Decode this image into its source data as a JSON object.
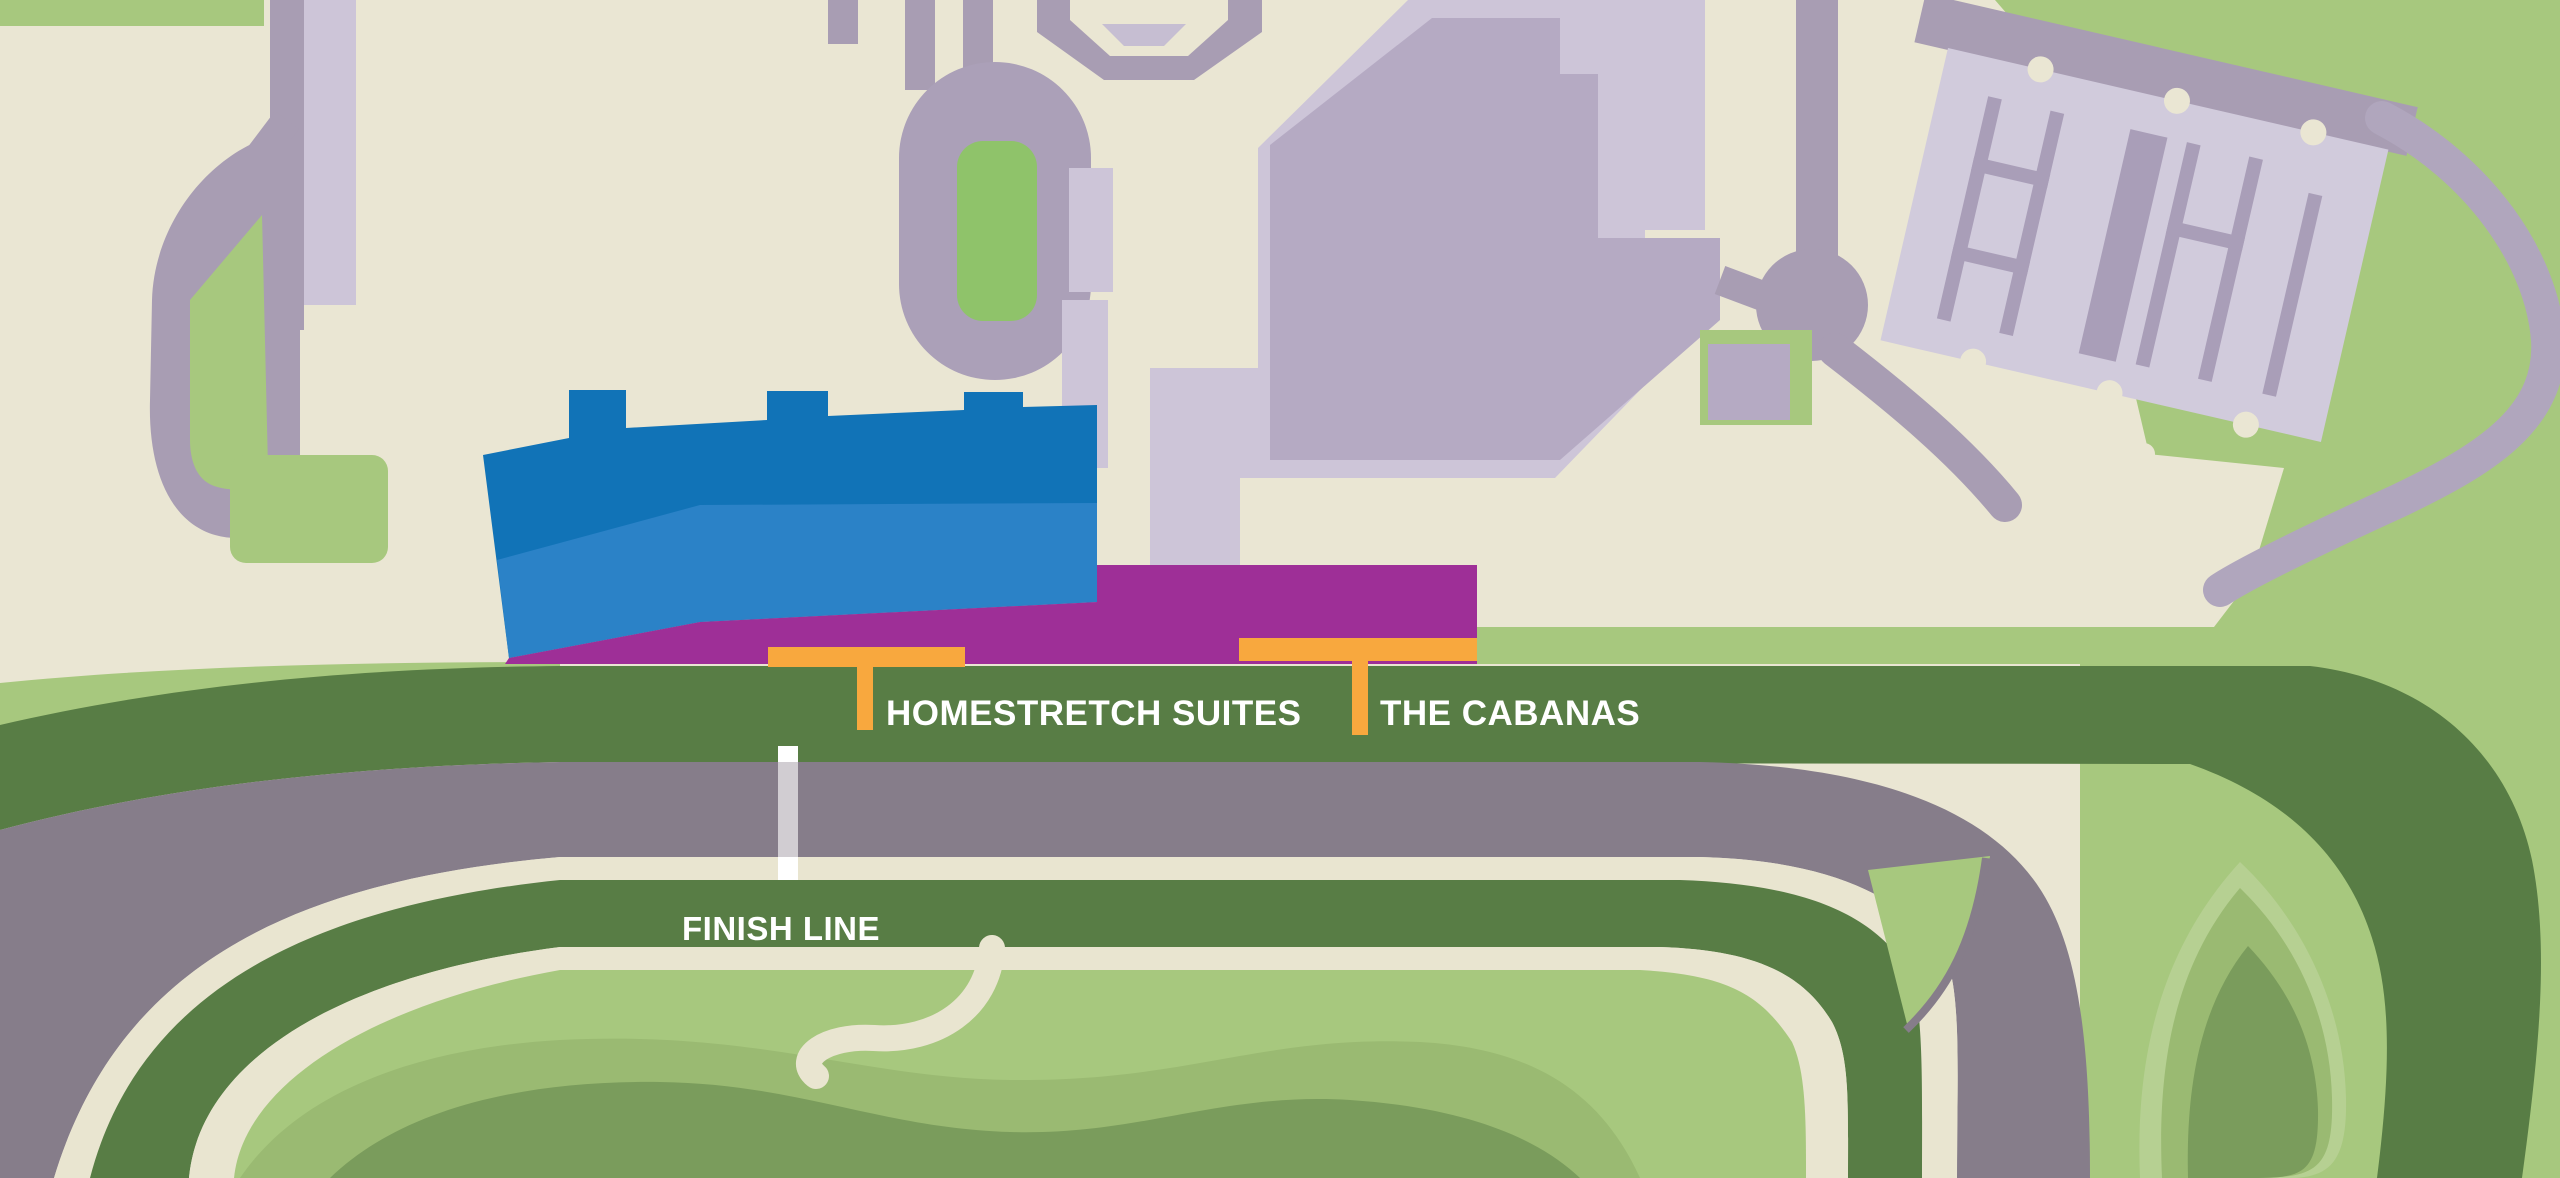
{
  "title": "Racetrack venue map",
  "labels": {
    "homestretch": "HOMESTRETCH SUITES",
    "cabanas": "THE CABANAS",
    "finish": "FINISH LINE"
  },
  "markers": [
    {
      "name": "homestretch-suites-marker",
      "label": "HOMESTRETCH SUITES",
      "color": "#f8a83e"
    },
    {
      "name": "cabanas-marker",
      "label": "THE CABANAS",
      "color": "#f8a83e"
    },
    {
      "name": "finish-line-marker",
      "label": "FINISH LINE",
      "color": "#ffffff"
    }
  ],
  "colors": {
    "cream_background": "#eae6d3",
    "cream_stripe": "#e9e5d0",
    "light_green": "#a7c87e",
    "lighter_green": "#b6d092",
    "mid_green": "#9aba72",
    "core_green": "#7a9c5c",
    "dark_green_track": "#587d45",
    "gray_dirt_track": "#867d8a",
    "road_mauve": "#a89db3",
    "plaza_light_mauve": "#cdc5d8",
    "building_mauve": "#b5aac3",
    "barn_light_mauve": "#d1cbdc",
    "barn_line_mauve": "#a99eb8",
    "grandstand_blue_dark": "#1173b7",
    "grandstand_blue_light": "#2b82c7",
    "suites_purple": "#9e2f97",
    "marker_orange": "#f8a83e",
    "label_white": "#ffffff"
  }
}
